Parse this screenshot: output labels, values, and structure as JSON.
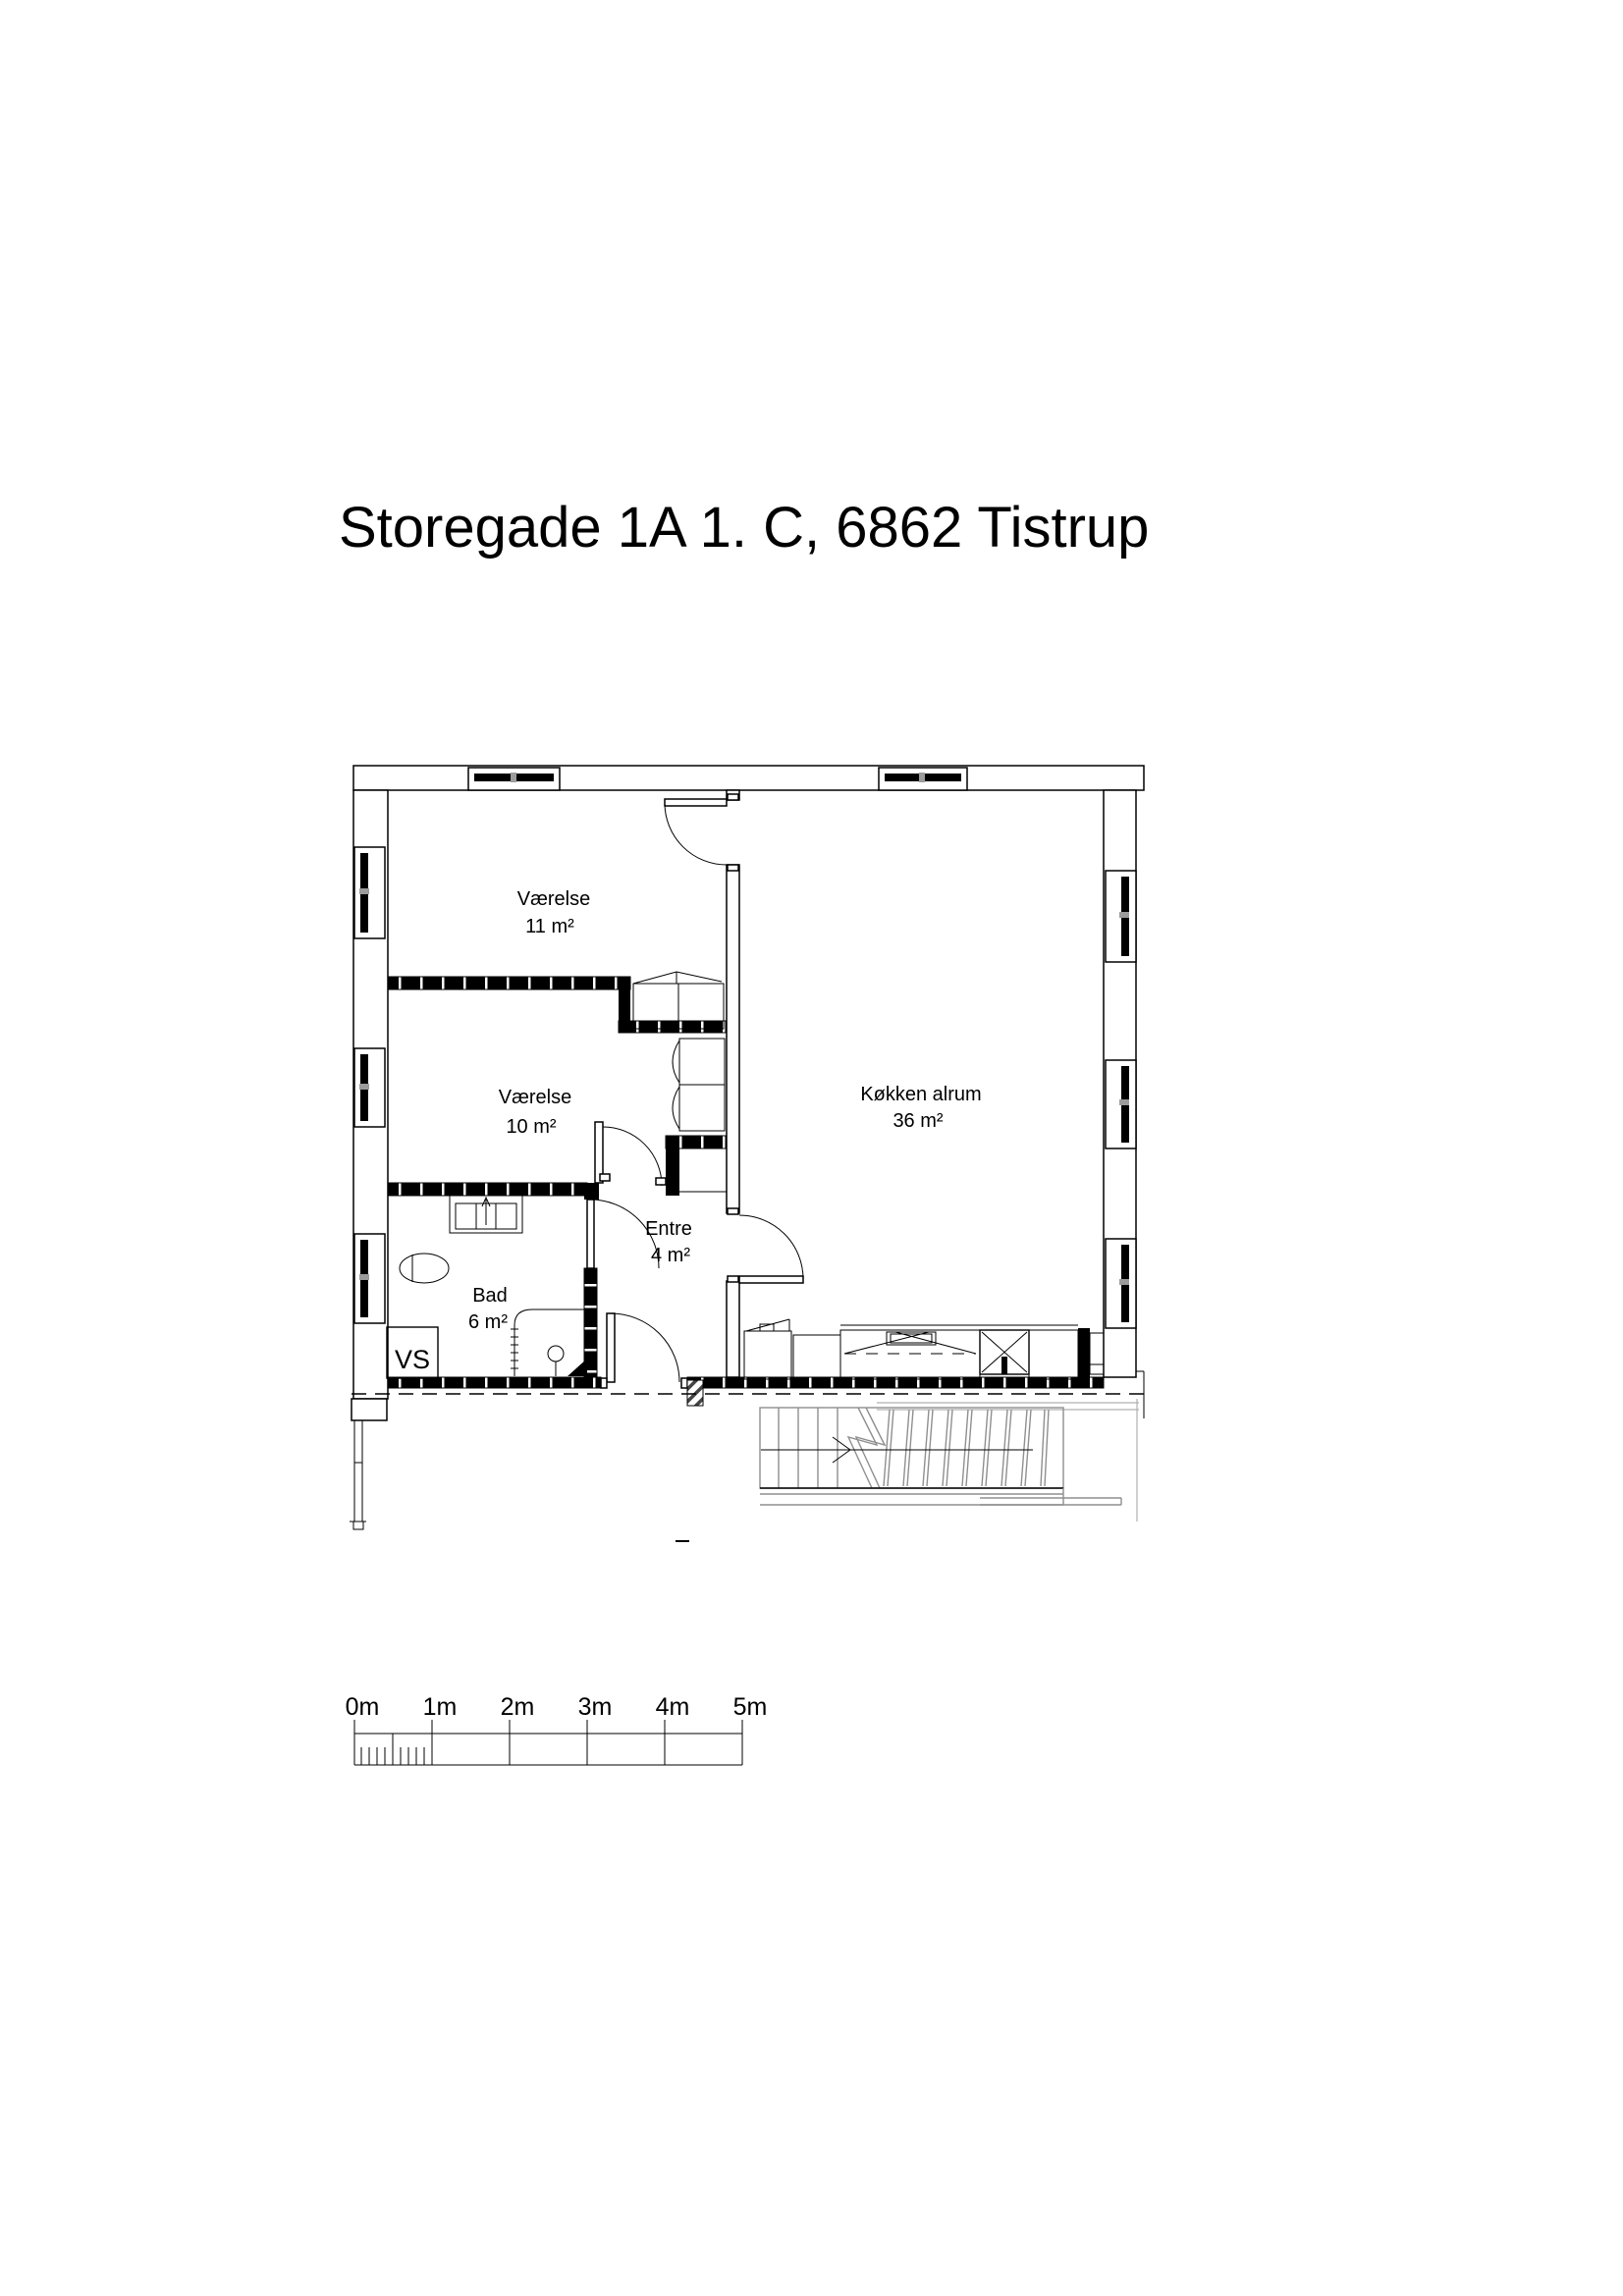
{
  "title": "Storegade 1A 1. C, 6862 Tistrup",
  "rooms": [
    {
      "name": "Værelse",
      "area": "11 m²"
    },
    {
      "name": "Værelse",
      "area": "10 m²"
    },
    {
      "name": "Køkken alrum",
      "area": "36 m²"
    },
    {
      "name": "Entre",
      "area": "4 m²"
    },
    {
      "name": "Bad",
      "area": "6 m²"
    }
  ],
  "shaft_label": "VS",
  "scale_bar": {
    "labels": [
      "0m",
      "1m",
      "2m",
      "3m",
      "4m",
      "5m"
    ]
  },
  "colors": {
    "wall": "#000000",
    "stair_gray": "#8f8f8f",
    "background": "#ffffff"
  }
}
